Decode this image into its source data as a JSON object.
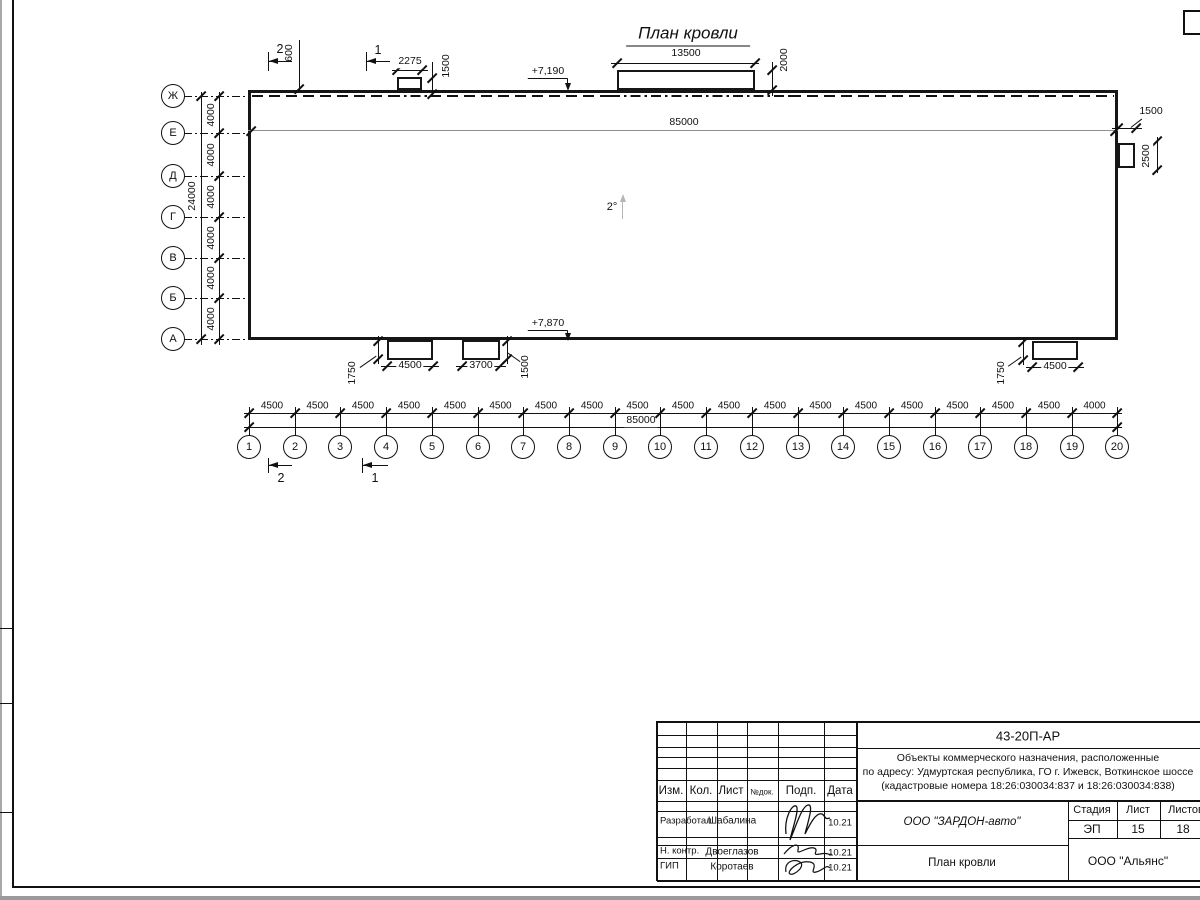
{
  "drawing": {
    "title": "План кровли",
    "slope": "2°",
    "elev_top": "+7,190",
    "elev_bottom": "+7,870",
    "total_top": "85000",
    "total_bottom": "85000",
    "parapet_offset": "600",
    "top_small_box": {
      "width": "2275",
      "offset": "1500"
    },
    "top_large_box": {
      "width": "13500",
      "offset": "2000"
    },
    "right_box": {
      "width": "1500",
      "height": "2500"
    },
    "bottom_box_left": {
      "width": "4500",
      "offset": "1750"
    },
    "bottom_box_mid": {
      "width": "3700",
      "offset": "1500"
    },
    "bottom_box_right": {
      "width": "4500",
      "offset": "1750"
    },
    "section_marks": {
      "s2": "2",
      "s1": "1"
    },
    "row_axes": {
      "labels": [
        "Ж",
        "Е",
        "Д",
        "Г",
        "В",
        "Б",
        "А"
      ],
      "spacings": [
        "4000",
        "4000",
        "4000",
        "4000",
        "4000",
        "4000"
      ],
      "total": "24000"
    },
    "col_axes": {
      "labels": [
        "1",
        "2",
        "3",
        "4",
        "5",
        "6",
        "7",
        "8",
        "9",
        "10",
        "11",
        "12",
        "13",
        "14",
        "15",
        "16",
        "17",
        "18",
        "19",
        "20"
      ],
      "spacings": [
        "4500",
        "4500",
        "4500",
        "4500",
        "4500",
        "4500",
        "4500",
        "4500",
        "4500",
        "4500",
        "4500",
        "4500",
        "4500",
        "4500",
        "4500",
        "4500",
        "4500",
        "4500",
        "4000"
      ],
      "total": "85000"
    }
  },
  "titleblock": {
    "doc_code": "43-20П-АР",
    "description_line1": "Объекты коммерческого назначения, расположенные",
    "description_line2": "по адресу: Удмуртская республика, ГО г. Ижевск, Воткинское шоссе",
    "description_line3": "(кадастровые номера 18:26:030034:837 и 18:26:030034:838)",
    "header_cells": {
      "izm": "Изм.",
      "kol": "Кол.",
      "list": "Лист",
      "ndok": "№док.",
      "podp": "Подп.",
      "data": "Дата"
    },
    "rows": [
      {
        "role": "Разработал",
        "name": "Шабалина",
        "date": "10.21"
      },
      {
        "role": "Н. контр.",
        "name": "Двоеглазов",
        "date": "10.21"
      },
      {
        "role": "ГИП",
        "name": "Коротаев",
        "date": "10.21"
      }
    ],
    "org": "ООО \"ЗАРДОН-авто\"",
    "sheet_title": "План кровли",
    "firm": "ООО \"Альянс\"",
    "stage_label": "Стадия",
    "sheet_label": "Лист",
    "sheets_label": "Листов",
    "stage_value": "ЭП",
    "sheet_value": "15",
    "sheets_value": "18"
  }
}
